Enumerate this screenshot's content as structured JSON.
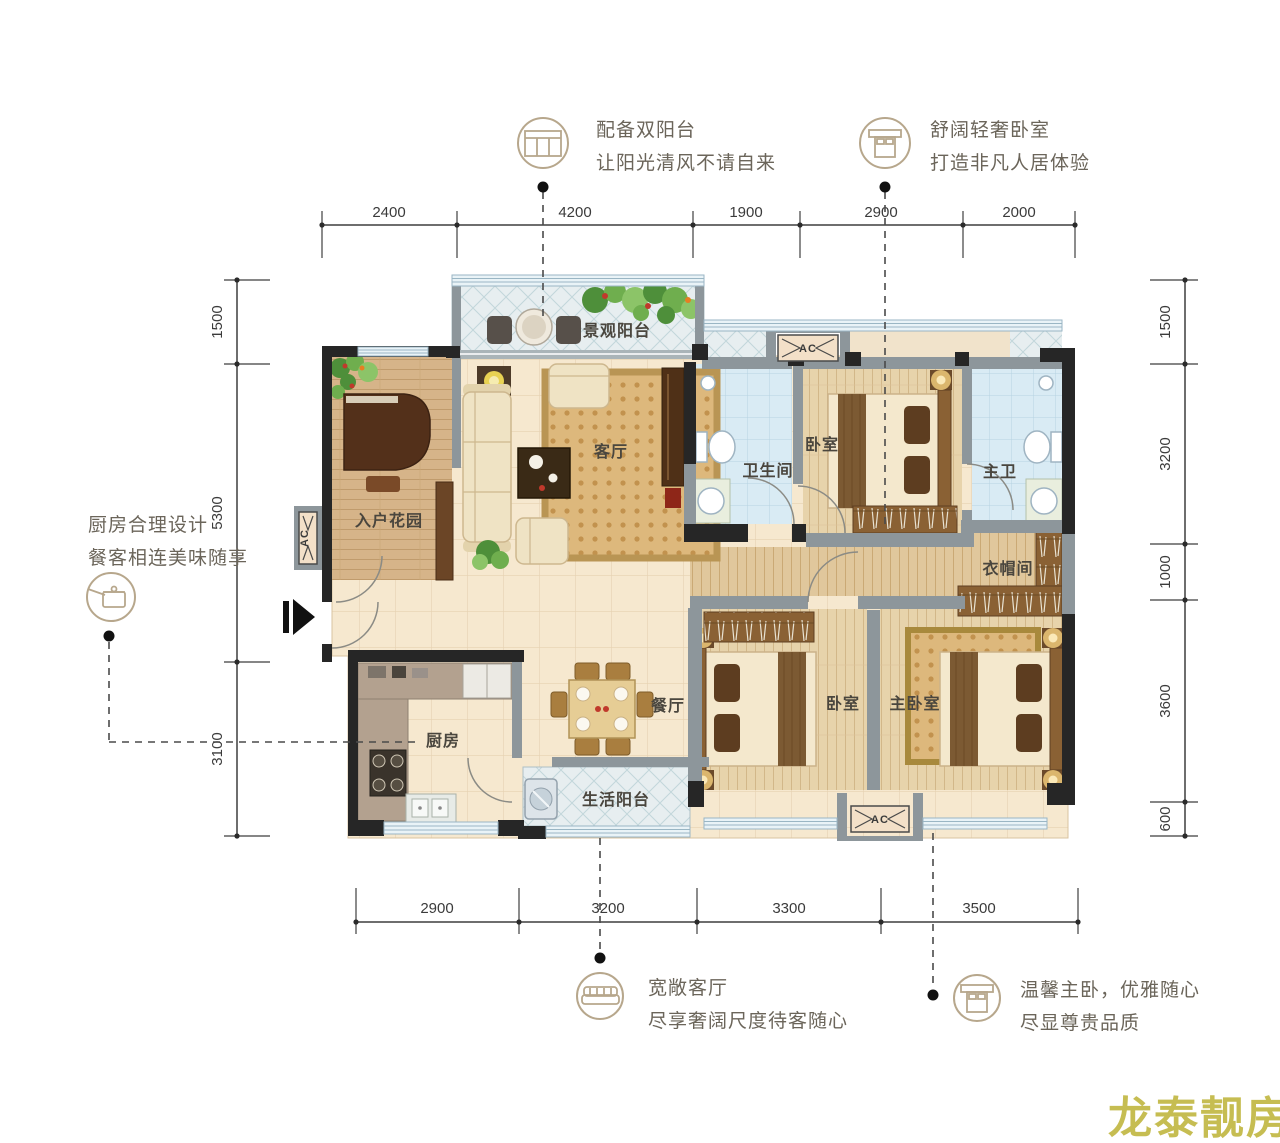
{
  "watermark": {
    "text": "龙泰靓房",
    "color": "#c6bd52"
  },
  "annotations": {
    "double_balcony": {
      "line1": "配备双阳台",
      "line2": "让阳光清风不请自来",
      "icon": "balcony-icon"
    },
    "cozy_bedroom": {
      "line1": "舒阔轻奢卧室",
      "line2": "打造非凡人居体验",
      "icon": "bed-icon"
    },
    "kitchen_design": {
      "line1": "厨房合理设计",
      "line2": "餐客相连美味随享",
      "icon": "kitchen-icon"
    },
    "wide_living": {
      "line1": "宽敞客厅",
      "line2": "尽享奢阔尺度待客随心",
      "icon": "sofa-icon"
    },
    "master_suite": {
      "line1": "温馨主卧，优雅随心",
      "line2": "尽显尊贵品质",
      "icon": "bed-icon"
    }
  },
  "dimensions": {
    "top": [
      "2400",
      "4200",
      "1900",
      "2900",
      "2000"
    ],
    "bottom": [
      "2900",
      "3200",
      "3300",
      "3500"
    ],
    "left": [
      "1500",
      "5300",
      "3100"
    ],
    "right": [
      "1500",
      "3200",
      "1000",
      "3600",
      "600"
    ]
  },
  "rooms": {
    "view_balcony": "景观阳台",
    "entry_garden": "入户花园",
    "living_room": "客厅",
    "bathroom": "卫生间",
    "bedroom_top": "卧室",
    "master_bath": "主卫",
    "cloakroom": "衣帽间",
    "dining_room": "餐厅",
    "kitchen": "厨房",
    "life_balcony": "生活阳台",
    "bedroom_second": "卧室",
    "master_bedroom": "主卧室"
  },
  "ac_label": "AC",
  "colors": {
    "wall_black": "#262626",
    "wall_gray": "#8d969b",
    "window_blue": "#9ab6c4",
    "floor_beige": "#f6e8cf",
    "annotation": "#6b655a"
  }
}
